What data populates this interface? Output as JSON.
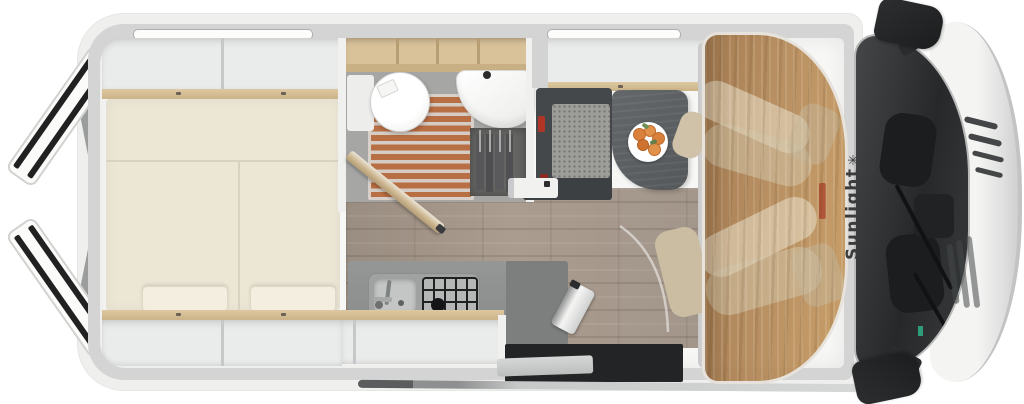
{
  "image": {
    "type": "motorhome-floorplan-top-view",
    "width_px": 1024,
    "height_px": 404
  },
  "brand": {
    "name": "Sunlight",
    "logo_glyph": "✳"
  },
  "vehicle": {
    "style": "camper van",
    "orientation": "rear at left, cab at right"
  },
  "rooms": {
    "rear_bedroom": {
      "name": "rear bedroom",
      "features": [
        "transverse double bed",
        "two mattress panels",
        "two pillows",
        "overhead lockers top wall",
        "overhead lockers bottom wall",
        "open rear doors"
      ]
    },
    "bathroom": {
      "name": "bathroom",
      "features": [
        "round toilet",
        "shower floor with wood slats",
        "washbasin",
        "wardrobe with hangers",
        "open bathroom door",
        "open wood shelves"
      ]
    },
    "kitchen": {
      "name": "kitchen",
      "features": [
        "counter",
        "sink with faucet",
        "gas hob with grate",
        "overhead lockers"
      ]
    },
    "dinette": {
      "name": "dinette",
      "features": [
        "bench seat with seatbelt buckles",
        "pedestal table",
        "plate of fruit"
      ]
    },
    "entry": {
      "name": "entry",
      "features": [
        "sliding door opening",
        "silver entry step",
        "folding step"
      ]
    },
    "cab": {
      "name": "cab",
      "features": [
        "swivel passenger seat",
        "swivel driver seat",
        "translucent roof panel",
        "windshield",
        "two side mirrors",
        "front grille"
      ]
    }
  },
  "window_strips": {
    "count": 2,
    "location": "top wall"
  },
  "colors": {
    "shell": "#efefee",
    "wall": "#d3d4d3",
    "interior": "#f7f7f6",
    "wood_trim": "#d6c096",
    "mattress": "#ece6d5",
    "bath_floor": "#a6a6a5",
    "shower_slat": "#b96f44",
    "counter": "#8f9290",
    "bench": "#45484a",
    "cushion": "#9d9d99",
    "table": "#595d60",
    "seat_beige": "#cfc2a8",
    "cab_roof": "#b08d60",
    "windshield": "#26282a",
    "red_accent": "#b03527",
    "floor_wood": "#a3968a",
    "brand_text": "#3b3b3b"
  }
}
